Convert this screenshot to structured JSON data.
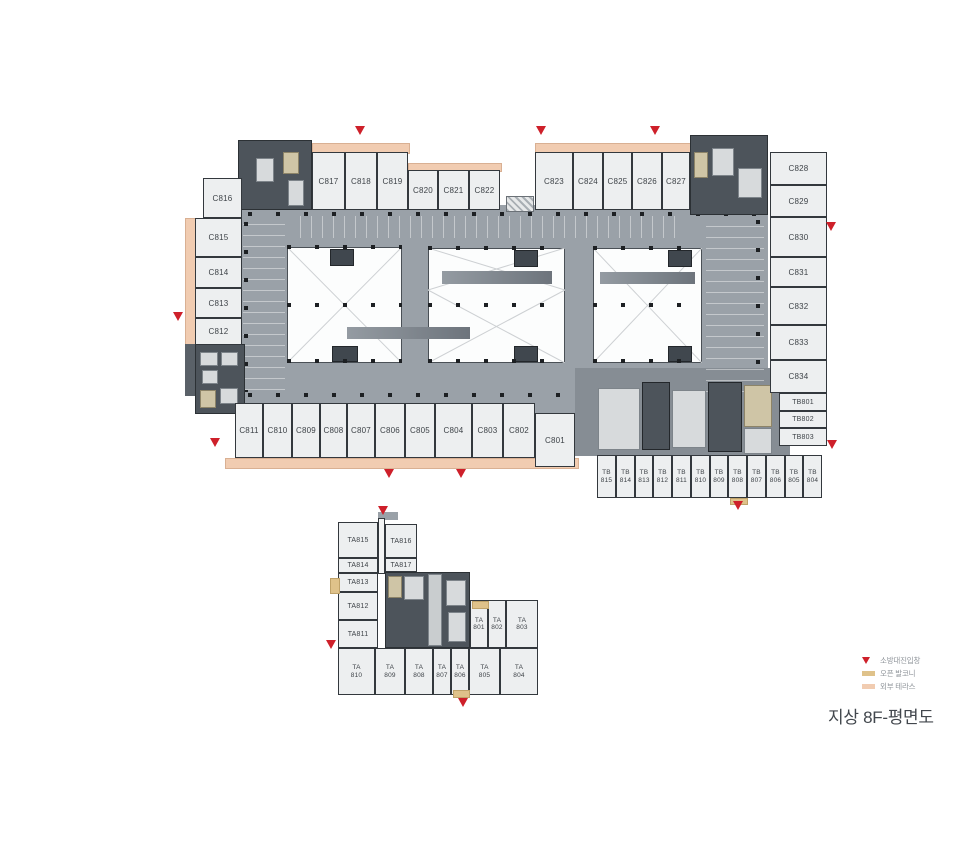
{
  "title": "지상 8F-평면도",
  "legend": {
    "fire_entry": "소방대진입창",
    "open_balcony": "오픈 발코니",
    "outer_terrace": "외부 테라스"
  },
  "colors": {
    "deck": "#9aa1a8",
    "room_fill": "#edeff0",
    "core": "#4d545b",
    "terrace": "#f1ccb1",
    "balcony": "#dfc28a",
    "fire_marker": "#ce202a"
  },
  "rooms": {
    "top_a": [
      "C817",
      "C818",
      "C819"
    ],
    "top_b": [
      "C820",
      "C821",
      "C822"
    ],
    "top_c": [
      "C823",
      "C824",
      "C825",
      "C826",
      "C827"
    ],
    "right_c": [
      "C828",
      "C829",
      "C830",
      "C831",
      "C832",
      "C833",
      "C834"
    ],
    "right_tb": [
      "TB801",
      "TB802",
      "TB803"
    ],
    "left_c": [
      "C816",
      "C815",
      "C814",
      "C813",
      "C812"
    ],
    "bottom_c": [
      "C811",
      "C810",
      "C809",
      "C808",
      "C807",
      "C806",
      "C805",
      "C804",
      "C803",
      "C802",
      "C801"
    ],
    "tb_row": [
      {
        "t": "TB",
        "n": "815"
      },
      {
        "t": "TB",
        "n": "814"
      },
      {
        "t": "TB",
        "n": "813"
      },
      {
        "t": "TB",
        "n": "812"
      },
      {
        "t": "TB",
        "n": "811"
      },
      {
        "t": "TB",
        "n": "810"
      },
      {
        "t": "TB",
        "n": "809"
      },
      {
        "t": "TB",
        "n": "808"
      },
      {
        "t": "TB",
        "n": "807"
      },
      {
        "t": "TB",
        "n": "806"
      },
      {
        "t": "TB",
        "n": "805"
      },
      {
        "t": "TB",
        "n": "804"
      }
    ],
    "ta_left": [
      "TA815",
      "TA816",
      "TA814",
      "TA817",
      "TA813",
      "TA812",
      "TA811"
    ],
    "ta_mid": [
      {
        "t": "TA",
        "n": "801"
      },
      {
        "t": "TA",
        "n": "802"
      },
      {
        "t": "TA",
        "n": "803"
      }
    ],
    "ta_bottom": [
      {
        "t": "TA",
        "n": "810"
      },
      {
        "t": "TA",
        "n": "809"
      },
      {
        "t": "TA",
        "n": "808"
      },
      {
        "t": "TA",
        "n": "807"
      },
      {
        "t": "TA",
        "n": "806"
      },
      {
        "t": "TA",
        "n": "805"
      },
      {
        "t": "TA",
        "n": "804"
      }
    ]
  }
}
